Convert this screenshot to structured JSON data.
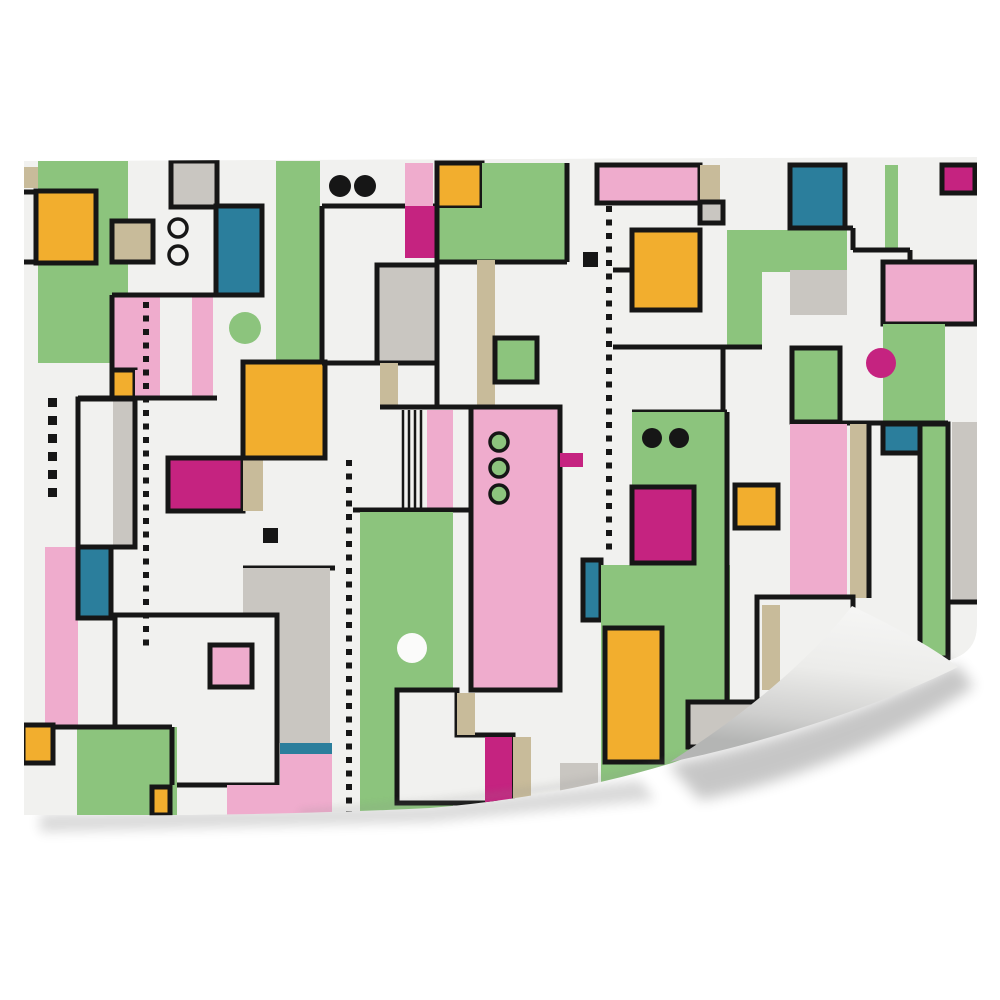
{
  "description": "Wall mural mockup: abstract geometric Bauhaus pattern on an off-white sheet with a page curl at the bottom-right corner",
  "canvas": {
    "width": 1000,
    "height": 1000,
    "background": "#ffffff"
  },
  "palette": {
    "bg": "#f1f1ef",
    "white": "#fbfbfa",
    "green": "#8cc47d",
    "pink": "#efaccd",
    "magenta": "#c52380",
    "orange": "#f2ae2e",
    "teal": "#2b7e9c",
    "gray": "#c9c6c1",
    "tan": "#c8bb9a",
    "black": "#161616"
  },
  "sheet": {
    "outline_d": "M24,161 L977,157 L977,626 Q977,652 950,660 L672,763 Q560,797 430,808 Q250,817 24,815 Z",
    "fill": "bg"
  },
  "shapes": [
    [
      "r",
      38,
      161,
      90,
      202,
      "green"
    ],
    [
      "r",
      276,
      161,
      44,
      202,
      "green"
    ],
    [
      "r",
      24,
      167,
      14,
      21,
      "tan"
    ],
    [
      "rb",
      171,
      161,
      46,
      46,
      "gray"
    ],
    [
      "ln",
      24,
      192,
      36,
      192
    ],
    [
      "ln",
      24,
      262,
      36,
      262
    ],
    [
      "rb",
      36,
      191,
      60,
      72,
      "orange"
    ],
    [
      "rb",
      112,
      221,
      41,
      41,
      "tan"
    ],
    [
      "rb",
      216,
      206,
      46,
      89,
      "teal"
    ],
    [
      "c",
      178,
      228,
      9,
      "bg",
      3.5
    ],
    [
      "c",
      178,
      255,
      9,
      "bg",
      3.5
    ],
    [
      "c",
      245,
      328,
      16,
      "green",
      0
    ],
    [
      "r",
      112,
      296,
      48,
      74,
      "pink"
    ],
    [
      "r",
      192,
      296,
      21,
      102,
      "pink"
    ],
    [
      "ln",
      112,
      295,
      262,
      295
    ],
    [
      "ln",
      112,
      295,
      112,
      372
    ],
    [
      "rb",
      112,
      370,
      23,
      28,
      "orange"
    ],
    [
      "r",
      135,
      370,
      25,
      28,
      "pink"
    ],
    [
      "ln",
      78,
      398,
      217,
      398
    ],
    [
      "r",
      113,
      399,
      22,
      148,
      "gray"
    ],
    [
      "ro",
      78,
      399,
      57,
      148
    ],
    [
      "r",
      45,
      547,
      33,
      180,
      "pink"
    ],
    [
      "rb",
      78,
      547,
      33,
      71,
      "teal"
    ],
    [
      "dots",
      48,
      398,
      492,
      9,
      18
    ],
    [
      "rb",
      168,
      458,
      75,
      53,
      "magenta"
    ],
    [
      "r",
      243,
      458,
      20,
      53,
      "tan"
    ],
    [
      "rb",
      243,
      362,
      82,
      96,
      "orange"
    ],
    [
      "ln",
      243,
      568,
      335,
      568
    ],
    [
      "r",
      243,
      568,
      87,
      47,
      "gray"
    ],
    [
      "r",
      277,
      615,
      53,
      128,
      "gray"
    ],
    [
      "sq",
      263,
      528,
      15
    ],
    [
      "rbw",
      115,
      615,
      162,
      170
    ],
    [
      "rb",
      210,
      645,
      42,
      42,
      "pink"
    ],
    [
      "r",
      77,
      727,
      100,
      88,
      "green"
    ],
    [
      "ln",
      53,
      727,
      172,
      727
    ],
    [
      "ln",
      172,
      727,
      172,
      785
    ],
    [
      "rb",
      23,
      725,
      30,
      38,
      "orange"
    ],
    [
      "rb",
      152,
      787,
      18,
      28,
      "orange"
    ],
    [
      "r",
      280,
      743,
      52,
      11,
      "teal"
    ],
    [
      "r",
      280,
      754,
      52,
      61,
      "pink"
    ],
    [
      "r",
      227,
      785,
      53,
      30,
      "pink"
    ],
    [
      "dots",
      143,
      302,
      640,
      6,
      13.5
    ],
    [
      "c",
      340,
      186,
      11,
      "black",
      0
    ],
    [
      "c",
      365,
      186,
      11,
      "black",
      0
    ],
    [
      "ln",
      322,
      206,
      567,
      206
    ],
    [
      "ln",
      322,
      206,
      322,
      363
    ],
    [
      "ln",
      322,
      363,
      437,
      363
    ],
    [
      "r",
      405,
      163,
      28,
      43,
      "pink"
    ],
    [
      "r",
      405,
      206,
      30,
      52,
      "magenta"
    ],
    [
      "rb",
      437,
      163,
      45,
      45,
      "orange"
    ],
    [
      "r",
      482,
      163,
      85,
      45,
      "green"
    ],
    [
      "r",
      437,
      208,
      130,
      54,
      "green"
    ],
    [
      "ln",
      567,
      163,
      567,
      262
    ],
    [
      "ln",
      437,
      262,
      567,
      262
    ],
    [
      "ln",
      437,
      206,
      437,
      407
    ],
    [
      "rb",
      377,
      265,
      60,
      98,
      "gray"
    ],
    [
      "r",
      380,
      363,
      18,
      44,
      "tan"
    ],
    [
      "ln",
      380,
      407,
      471,
      407
    ],
    [
      "ln",
      403,
      410,
      403,
      510,
      2.5
    ],
    [
      "ln",
      409,
      410,
      409,
      510,
      2.5
    ],
    [
      "ln",
      415,
      410,
      415,
      510,
      2.5
    ],
    [
      "ln",
      421,
      410,
      421,
      510,
      2.5
    ],
    [
      "r",
      427,
      410,
      26,
      100,
      "pink"
    ],
    [
      "r",
      477,
      260,
      18,
      147,
      "tan"
    ],
    [
      "rb",
      495,
      338,
      42,
      44,
      "green"
    ],
    [
      "ln",
      353,
      510,
      471,
      510
    ],
    [
      "r",
      360,
      512,
      93,
      300,
      "green"
    ],
    [
      "c",
      412,
      648,
      15,
      "white",
      0
    ],
    [
      "rb",
      471,
      407,
      89,
      283,
      "pink"
    ],
    [
      "c",
      499,
      442,
      9,
      "green",
      3.5
    ],
    [
      "c",
      499,
      468,
      9,
      "green",
      3.5
    ],
    [
      "c",
      499,
      494,
      9,
      "green",
      3.5
    ],
    [
      "r",
      560,
      453,
      23,
      14,
      "magenta"
    ],
    [
      "pb",
      "M397,690 L457,690 L457,735 L513,735 L513,803 L397,803 Z"
    ],
    [
      "r",
      457,
      693,
      18,
      42,
      "tan"
    ],
    [
      "r",
      485,
      737,
      27,
      66,
      "magenta"
    ],
    [
      "r",
      513,
      737,
      18,
      66,
      "tan"
    ],
    [
      "r",
      485,
      803,
      28,
      11,
      "orange"
    ],
    [
      "r",
      560,
      763,
      38,
      28,
      "gray"
    ],
    [
      "rb",
      583,
      560,
      18,
      60,
      "teal"
    ],
    [
      "sq",
      583,
      252,
      15
    ],
    [
      "dots",
      606,
      206,
      556,
      6,
      13.5
    ],
    [
      "rb",
      597,
      165,
      103,
      38,
      "pink"
    ],
    [
      "r",
      700,
      165,
      20,
      37,
      "tan"
    ],
    [
      "rb",
      700,
      202,
      23,
      21,
      "gray"
    ],
    [
      "rb",
      632,
      230,
      68,
      80,
      "orange"
    ],
    [
      "r",
      727,
      230,
      120,
      42,
      "green"
    ],
    [
      "r",
      727,
      272,
      35,
      75,
      "green"
    ],
    [
      "r",
      790,
      270,
      57,
      45,
      "gray"
    ],
    [
      "ln",
      613,
      270,
      632,
      270
    ],
    [
      "ln",
      613,
      347,
      762,
      347
    ],
    [
      "ln",
      723,
      347,
      723,
      412
    ],
    [
      "ln",
      632,
      412,
      727,
      412
    ],
    [
      "rb",
      790,
      165,
      55,
      63,
      "teal"
    ],
    [
      "r",
      885,
      165,
      13,
      86,
      "green"
    ],
    [
      "ln",
      790,
      228,
      853,
      228
    ],
    [
      "ln",
      853,
      228,
      853,
      250
    ],
    [
      "ln",
      853,
      250,
      910,
      250
    ],
    [
      "ln",
      910,
      250,
      910,
      263
    ],
    [
      "rb",
      942,
      165,
      33,
      28,
      "magenta"
    ],
    [
      "rb",
      883,
      262,
      93,
      62,
      "pink"
    ],
    [
      "r",
      883,
      324,
      62,
      101,
      "green"
    ],
    [
      "c",
      881,
      363,
      15,
      "magenta",
      0
    ],
    [
      "rb",
      792,
      348,
      48,
      74,
      "green"
    ],
    [
      "ln",
      790,
      423,
      948,
      423
    ],
    [
      "r",
      790,
      424,
      57,
      174,
      "pink"
    ],
    [
      "r",
      850,
      424,
      17,
      174,
      "tan"
    ],
    [
      "ln",
      869,
      424,
      869,
      598
    ],
    [
      "rb",
      883,
      424,
      39,
      29,
      "teal"
    ],
    [
      "rb",
      920,
      424,
      28,
      234,
      "green"
    ],
    [
      "r",
      952,
      422,
      25,
      180,
      "gray"
    ],
    [
      "ln",
      948,
      602,
      977,
      602
    ],
    [
      "r",
      632,
      412,
      95,
      155,
      "green"
    ],
    [
      "r",
      601,
      565,
      129,
      240,
      "green"
    ],
    [
      "c",
      652,
      438,
      10,
      "black",
      0
    ],
    [
      "c",
      679,
      438,
      10,
      "black",
      0
    ],
    [
      "rb",
      632,
      487,
      62,
      76,
      "magenta"
    ],
    [
      "rb",
      735,
      485,
      43,
      43,
      "orange"
    ],
    [
      "ln",
      727,
      412,
      727,
      705
    ],
    [
      "rb",
      605,
      628,
      57,
      134,
      "orange"
    ],
    [
      "rbw",
      757,
      597,
      96,
      106
    ],
    [
      "r",
      762,
      605,
      18,
      85,
      "tan"
    ],
    [
      "rb",
      688,
      702,
      70,
      45,
      "gray"
    ],
    [
      "dots",
      346,
      460,
      812,
      6,
      13.5
    ]
  ],
  "curl": {
    "flap_d": "M852,606 C818,650 757,707 670,762 C760,744 880,706 958,667 C930,645 885,622 852,606 Z",
    "gradient": [
      [
        "0",
        "#f6f6f5"
      ],
      [
        "0.45",
        "#ececea"
      ],
      [
        "0.8",
        "#cfcfce"
      ],
      [
        "1",
        "#b4b5b4"
      ]
    ],
    "gradient_from": [
      852,
      604
    ],
    "gradient_to": [
      836,
      752
    ]
  },
  "shadows": [
    {
      "d": "M40,814 L430,806 L640,780 L655,800 L430,822 L40,832 Z",
      "opacity": 0.15,
      "blur": 6
    },
    {
      "d": "M668,764 C770,744 890,702 956,664 L974,686 C905,735 790,783 700,800 Z",
      "opacity": 0.22,
      "blur": 7
    }
  ],
  "crease": {
    "d": "M300,813 Q560,796 672,762 Q850,712 952,658",
    "stroke": "#8a8a8a",
    "opacity": 0.28,
    "width": 5,
    "blur": 4
  },
  "stroke_width": 5
}
